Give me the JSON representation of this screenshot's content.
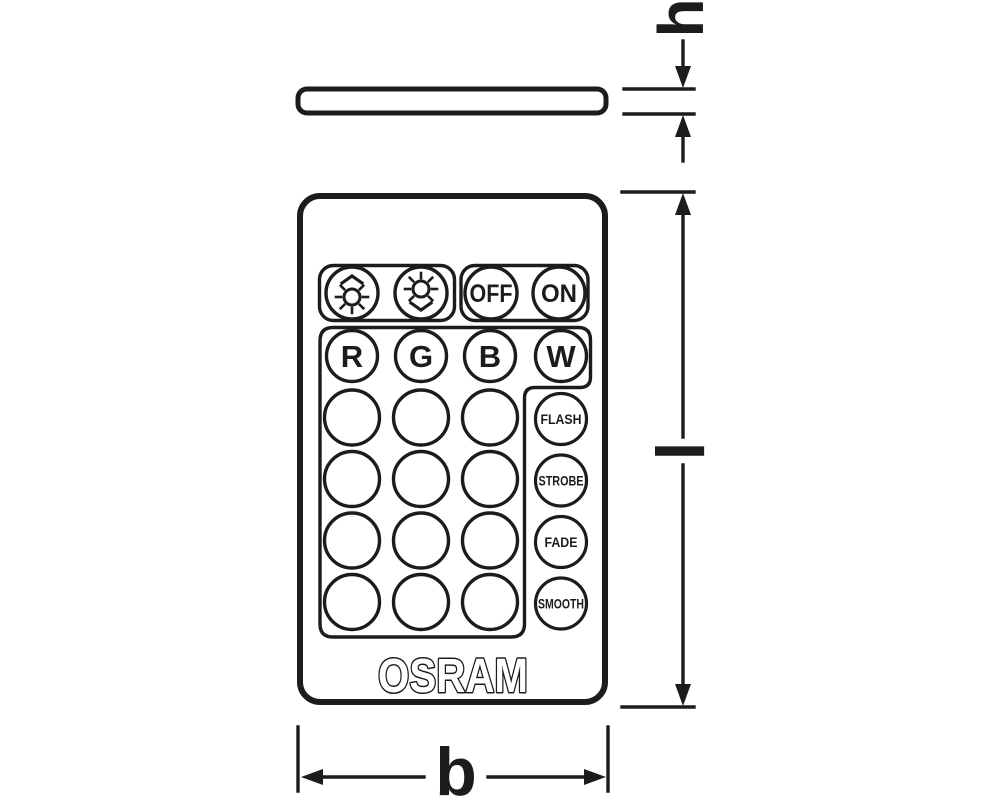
{
  "drawing": {
    "type": "product-dimension-drawing",
    "subject": "LED remote control with side profile view and dimension callouts",
    "line_color": "#1c1c1c",
    "background_color": "#ffffff"
  },
  "dimensions": {
    "height": "h",
    "length": "l",
    "width": "b"
  },
  "remote": {
    "brand": "OSRAM",
    "buttons": {
      "brightness_up": {
        "icon": "sun-arrow-up-icon"
      },
      "brightness_down": {
        "icon": "sun-arrow-down-icon"
      },
      "power": [
        "OFF",
        "ON"
      ],
      "colors": [
        "R",
        "G",
        "B",
        "W"
      ],
      "modes": [
        "FLASH",
        "STROBE",
        "FADE",
        "SMOOTH"
      ],
      "blank_buttons": {
        "rows": 4,
        "columns": 3
      }
    }
  }
}
